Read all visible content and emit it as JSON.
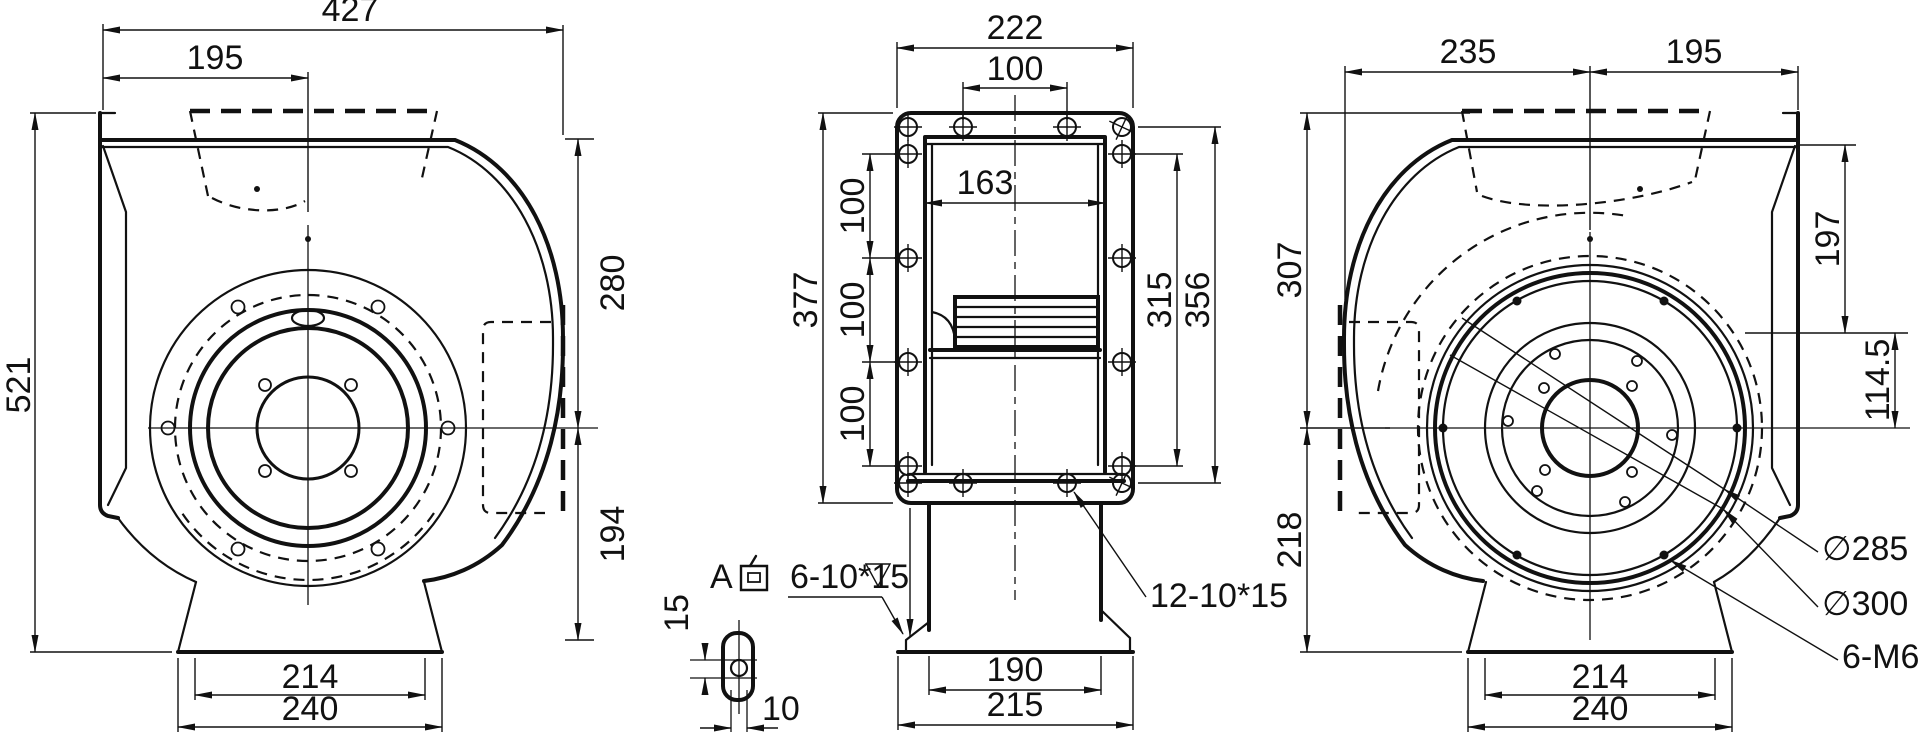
{
  "views": {
    "front": {
      "dims": {
        "width": "427",
        "inlet_offset": "195",
        "height": "521",
        "upper": "280",
        "lower": "194",
        "foot_span": "214",
        "foot_width": "240"
      }
    },
    "side": {
      "dims": {
        "width": "222",
        "hole_pitch_top": "100",
        "inner_width": "163",
        "height": "377",
        "pitch1": "100",
        "pitch2": "100",
        "pitch3": "100",
        "span_inner": "315",
        "span_outer": "356",
        "outlet_inner": "190",
        "outlet_outer": "215"
      },
      "labels": {
        "flange_slots": "12-10*15",
        "view_ref": "A向",
        "view_ref_latin": "A",
        "foot_slots": "6-10*15"
      },
      "detail": {
        "slot_length": "15",
        "slot_width": "10"
      }
    },
    "back": {
      "dims": {
        "left": "235",
        "right": "195",
        "upper": "307",
        "lower": "218",
        "ring_top": "197",
        "ring_mid": "114.5",
        "foot_span": "214",
        "foot_width": "240"
      },
      "labels": {
        "bolt_circle": "∅285",
        "ring_od": "∅300",
        "tapped_holes": "6-M6"
      }
    }
  }
}
